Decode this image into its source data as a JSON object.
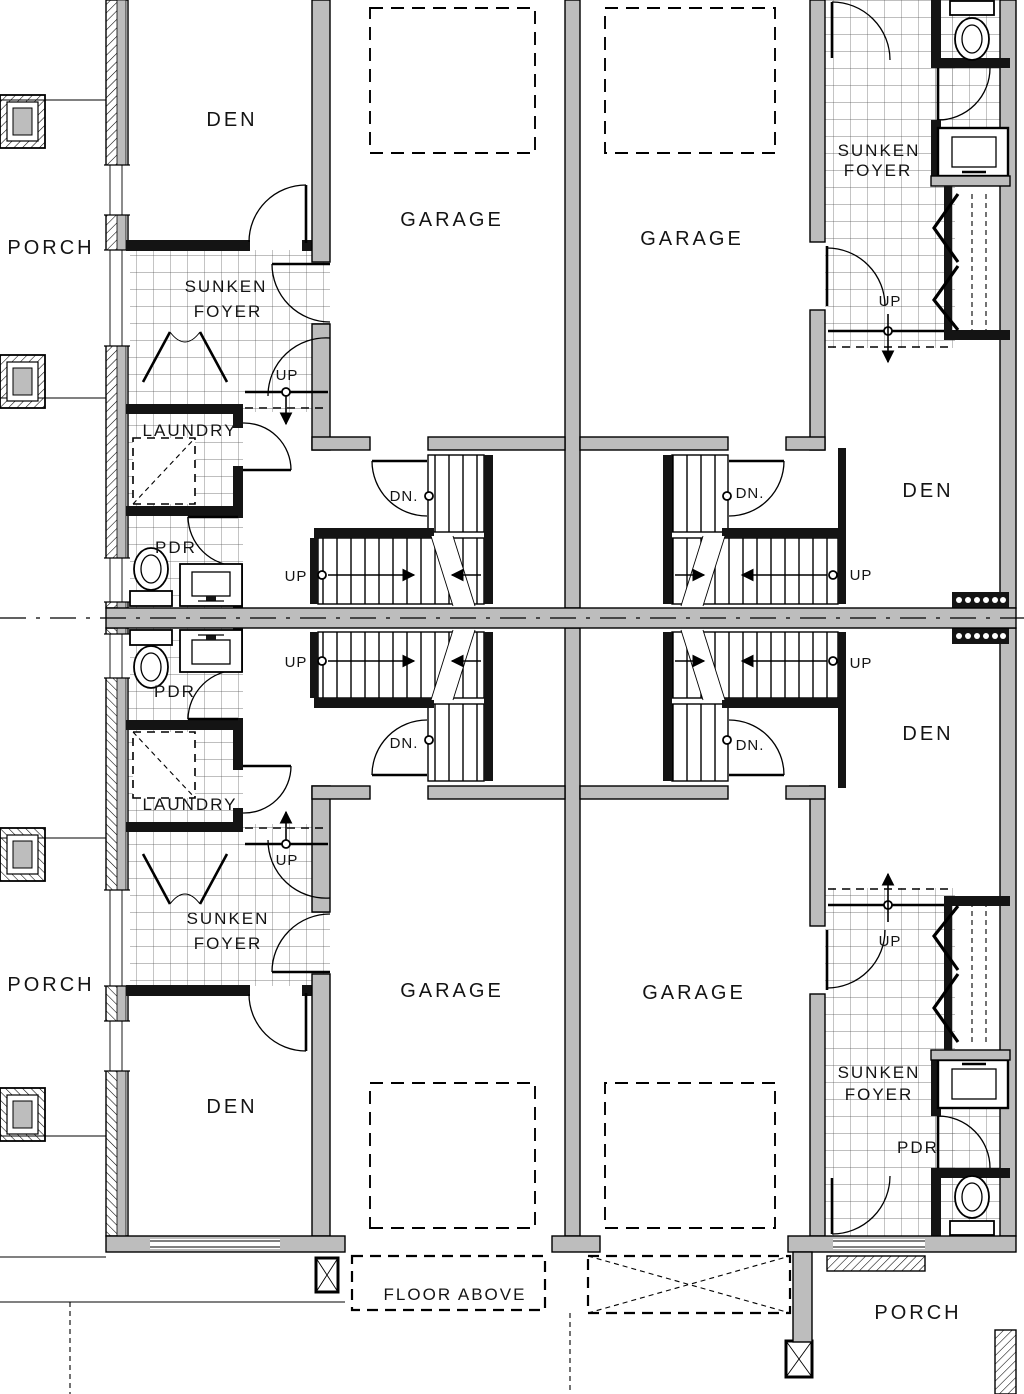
{
  "drawing": {
    "kind": "architectural floor plan",
    "description": "Ground-floor plan of four mirrored attached townhouse units"
  },
  "colors": {
    "background": "#ffffff",
    "wall_poche_gray": "#bdbdbd",
    "line_black": "#141414"
  },
  "units": {
    "top_left": {
      "porch": "PORCH",
      "den": "DEN",
      "garage": "GARAGE",
      "sunken": "SUNKEN",
      "foyer": "FOYER",
      "up_foyer": "UP",
      "laundry": "LAUNDRY",
      "pdr": "PDR",
      "dn_stair": "DN.",
      "up_stair": "UP"
    },
    "top_right": {
      "garage": "GARAGE",
      "den": "DEN",
      "sunken": "SUNKEN",
      "foyer": "FOYER",
      "up_foyer": "UP",
      "dn_stair": "DN.",
      "up_stair": "UP"
    },
    "bottom_left": {
      "porch": "PORCH",
      "den": "DEN",
      "garage": "GARAGE",
      "sunken": "SUNKEN",
      "foyer": "FOYER",
      "up_foyer": "UP",
      "laundry": "LAUNDRY",
      "pdr": "PDR",
      "dn_stair": "DN.",
      "up_stair": "UP"
    },
    "bottom_right": {
      "porch": "PORCH",
      "den": "DEN",
      "garage": "GARAGE",
      "sunken": "SUNKEN",
      "foyer": "FOYER",
      "up_foyer": "UP",
      "pdr": "PDR",
      "dn_stair": "DN.",
      "up_stair": "UP"
    }
  },
  "annotations": {
    "floor_above": "FLOOR ABOVE"
  }
}
